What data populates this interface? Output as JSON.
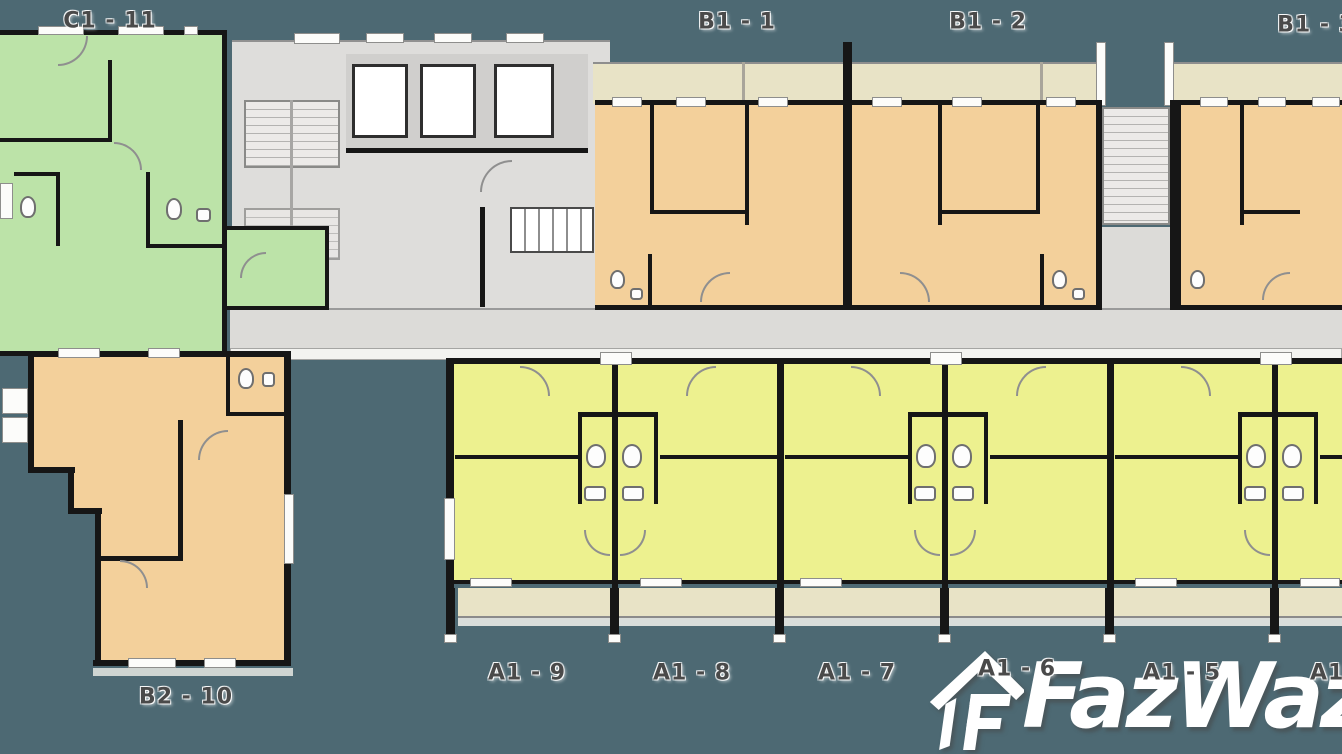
{
  "image_type": "condo-floor-plan",
  "watermark": {
    "brand": "FazWaz"
  },
  "units": {
    "c1_11": "C1 - 11",
    "b1_1": "B1 - 1",
    "b1_2": "B1 - 2",
    "b1_3": "B1 - 3",
    "b2_10": "B2 - 10",
    "a1_9": "A1 - 9",
    "a1_8": "A1 - 8",
    "a1_7": "A1 - 7",
    "a1_6": "A1 - 6",
    "a1_5": "A1 - 5",
    "a1_4": "A1 - 4"
  },
  "colors": {
    "background": "#4d6973",
    "unit_green": "#bce3a8",
    "unit_orange": "#f3d09b",
    "unit_yellow": "#edf18f",
    "corridor": "#dcdbd8",
    "balcony": "#e8e3c6",
    "wall": "#161616",
    "watermark": "#ffffff"
  }
}
